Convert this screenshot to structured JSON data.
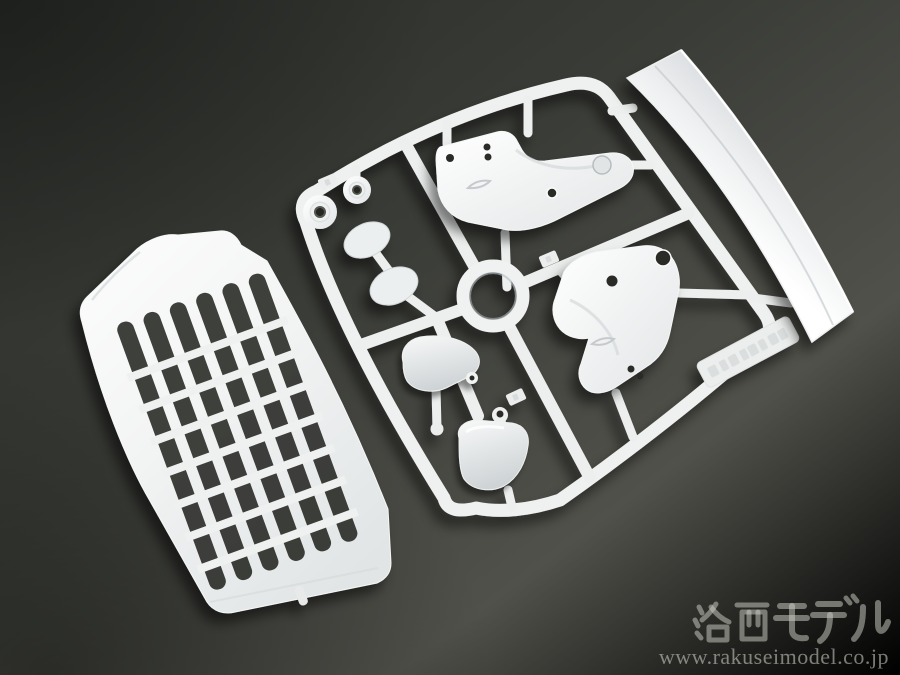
{
  "meta": {
    "kind": "product-photo",
    "subject": "White plastic model-kit sprue (runner) with truck body parts on a dark gray studio background"
  },
  "watermark": {
    "shop_name": "洛西モデル",
    "url": "www.rakuseimodel.co.jp"
  },
  "colors": {
    "background_dark": "#292b28",
    "background_light": "#6e6e66",
    "plastic_white": "#f2f4f3",
    "plastic_shadow": "#c9ccd0",
    "opening_shadow": "#1e201b",
    "watermark_text": "rgba(206,206,198,0.52)"
  },
  "parts": [
    {
      "id": "front-grille-panel",
      "label": "Truck front grille panel with slatted vents"
    },
    {
      "id": "runner-frame",
      "label": "Sprue runner frame"
    },
    {
      "id": "center-ring",
      "label": "Round ring part"
    },
    {
      "id": "grommet-a",
      "label": "Small round grommet part"
    },
    {
      "id": "grommet-b",
      "label": "Small round grommet part"
    },
    {
      "id": "mirror-face-a",
      "label": "Oval mirror face part"
    },
    {
      "id": "mirror-face-b",
      "label": "Oval mirror face part"
    },
    {
      "id": "bracket-left",
      "label": "Curved bracket part with holes (left)"
    },
    {
      "id": "bracket-right",
      "label": "Curved bracket part with holes (right)"
    },
    {
      "id": "mirror-housing-upper",
      "label": "Mirror housing shell part"
    },
    {
      "id": "mirror-housing-lower",
      "label": "Mirror housing shell part"
    },
    {
      "id": "side-deflector-strip",
      "label": "Long curved air deflector strip"
    },
    {
      "id": "molded-text-tag",
      "label": "Molded embossed text tag on runner"
    }
  ]
}
